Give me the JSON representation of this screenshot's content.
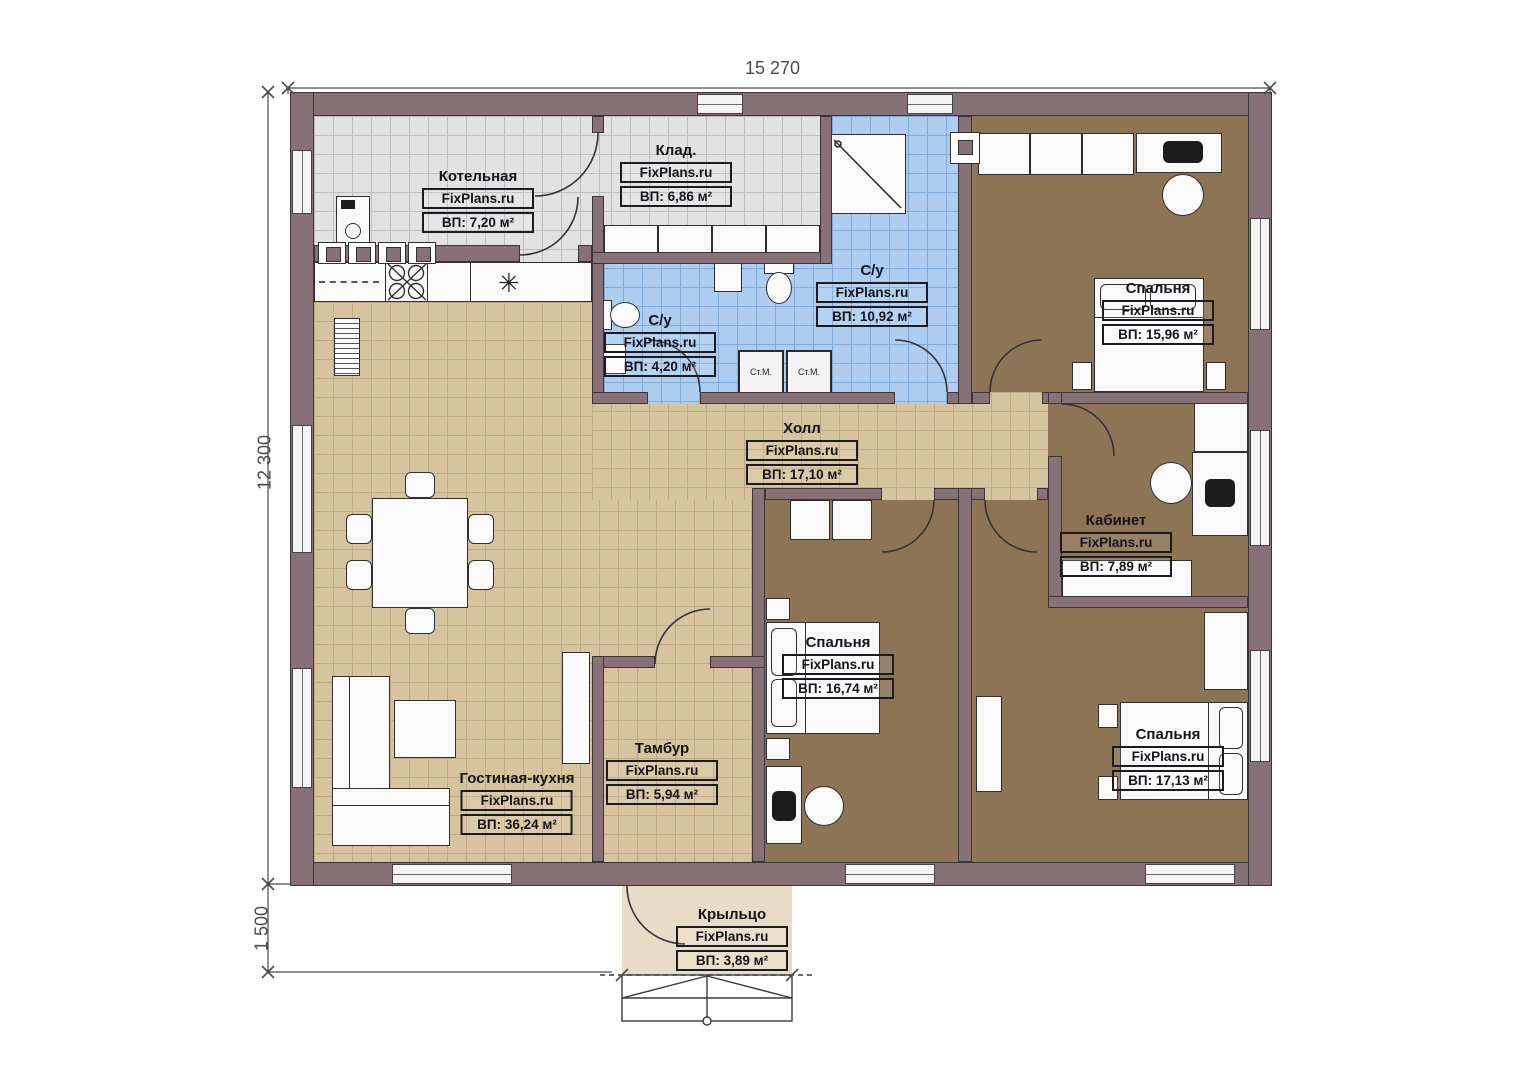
{
  "brand": "FixPlans.ru",
  "dims": {
    "width": "15 270",
    "depth": "12 300",
    "porch": "1 500"
  },
  "rooms": [
    {
      "key": "kotelnaya",
      "name": "Котельная",
      "area": "ВП: 7,20 м²"
    },
    {
      "key": "klad",
      "name": "Клад.",
      "area": "ВП: 6,86 м²"
    },
    {
      "key": "su_big",
      "name": "С/у",
      "area": "ВП: 10,92 м²"
    },
    {
      "key": "su_small",
      "name": "С/у",
      "area": "ВП: 4,20 м²"
    },
    {
      "key": "bedroom_tr",
      "name": "Спальня",
      "area": "ВП: 15,96 м²"
    },
    {
      "key": "hall",
      "name": "Холл",
      "area": "ВП: 17,10 м²"
    },
    {
      "key": "kabinet",
      "name": "Кабинет",
      "area": "ВП: 7,89 м²"
    },
    {
      "key": "bedroom_mid",
      "name": "Спальня",
      "area": "ВП: 16,74 м²"
    },
    {
      "key": "bedroom_br",
      "name": "Спальня",
      "area": "ВП: 17,13 м²"
    },
    {
      "key": "living",
      "name": "Гостиная-кухня",
      "area": "ВП: 36,24 м²"
    },
    {
      "key": "tambur",
      "name": "Тамбур",
      "area": "ВП: 5,94 м²"
    },
    {
      "key": "porch",
      "name": "Крыльцо",
      "area": "ВП: 3,89 м²"
    }
  ],
  "appliances": {
    "washer": "Ст.М."
  },
  "symbols": {
    "fridge_mark": "✳"
  },
  "colors": {
    "wall": "#877176",
    "wall_outline": "#3d3438",
    "tile_gray": "#e2e2e2",
    "tile_blue": "#aecdf0",
    "tile_tan": "#d6c49f",
    "floor_brown": "#8d7455",
    "porch": "#e9dcc6"
  }
}
